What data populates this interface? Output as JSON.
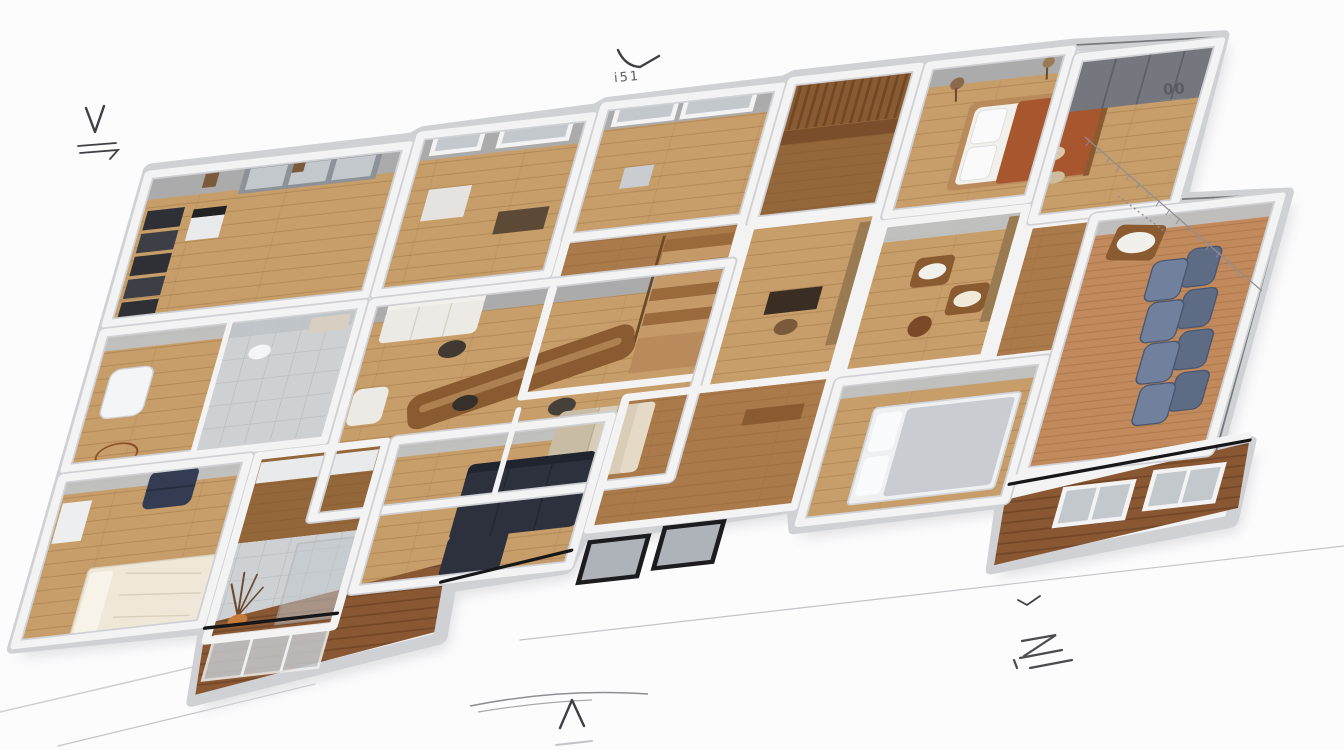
{
  "scene": {
    "kind": "3d-isometric-floor-plan-render",
    "style": "photoreal cutaway model of a single-storey house on white paper with faint pencil sketch marks",
    "background": "white"
  },
  "annotations": {
    "top_center_label": "i51",
    "top_right_label": "00"
  },
  "marks": {
    "top_center_check": "curved-check-stroke",
    "left_margin_mark": "v-with-bracket-arrow",
    "bottom_center_mark": "caret-arrow",
    "bottom_right_mark": "z-scribble-with-underlines",
    "bottom_right_tick": "small-check",
    "top_right_dimension": "hatched-diagonal-dimension-line",
    "ground_lines": "faint-pencil-ground-lines"
  },
  "palette": {
    "paper": "#fcfcfd",
    "wall-light": "#f3f3f4",
    "wall-edge": "#cfd1d5",
    "wall-face": "#a8acb2",
    "wall-face-light": "#bfc3c8",
    "wall-cut": "#17171a",
    "floor-light": "#c79e6a",
    "floor-rich": "#aa7a4a",
    "floor-dark": "#93673a",
    "floor-terra": "#c28a5c",
    "plank-line": "#7e5227",
    "tile": "#ced1d4",
    "tile-line": "#b8bbbf",
    "deck": "#8a5733",
    "deck-line": "#5f3c20",
    "shadow": "#dcdcdf",
    "sofa-navy": "#2c313d",
    "sofa-navy-dark": "#20242e",
    "denim": "#5d6b85",
    "denim-light": "#71809c",
    "beige": "#d9cdb8",
    "beige-dark": "#c9bca4",
    "white-soft": "#eceae4",
    "linen": "#f2f0ea",
    "rust": "#a8562e",
    "cream": "#efe8d8",
    "shelf-dark": "#2e3035",
    "shelf-dark2": "#3c3f45",
    "wood": "#8a5a30",
    "wood-light": "#b98a5c",
    "glass": "#c3c8cd",
    "glass-dark": "#aeb3ba",
    "frame-dark": "#1c1c1e",
    "orange": "#c77b3a",
    "ink": "#3f3f44",
    "ink-soft": "#8f8f94",
    "sketch": "#c4c4c8"
  },
  "rooms": [
    {
      "id": "storage-room-nw",
      "floor": "light-oak",
      "contents": [
        "dark-shelving-stack",
        "glass-display-cabinet",
        "device-table",
        "wall-frames"
      ]
    },
    {
      "id": "bedroom-nw",
      "floor": "light-oak",
      "contents": [
        "windows",
        "cabinet",
        "wood-bench"
      ]
    },
    {
      "id": "window-room-n",
      "floor": "light-oak",
      "contents": [
        "windows",
        "side-table"
      ]
    },
    {
      "id": "stair-hall",
      "floor": "rich-oak",
      "contents": [
        "staircase",
        "railing",
        "landing"
      ]
    },
    {
      "id": "wardrobe-corridor",
      "floor": "dark-walnut",
      "contents": [
        "wood-slat-wardrobe"
      ]
    },
    {
      "id": "bedroom-ne",
      "floor": "light-oak",
      "contents": [
        "double-bed-rust-blanket",
        "pillows",
        "coat-stand"
      ]
    },
    {
      "id": "closet-room-e",
      "floor": "light-oak",
      "contents": [
        "gray-wardrobe",
        "floor-cushions"
      ]
    },
    {
      "id": "bathroom-w",
      "floor": "light-oak-and-tile",
      "contents": [
        "bathtub",
        "toilet",
        "vanity",
        "sketch-round-table"
      ]
    },
    {
      "id": "living-room",
      "floor": "light-oak",
      "contents": [
        "white-sofa",
        "white-armchair",
        "wood-dining-table",
        "stools",
        "beige-sectional"
      ]
    },
    {
      "id": "study-e",
      "floor": "light-oak",
      "contents": [
        "dark-desk",
        "desk-chair",
        "wall-shelf"
      ]
    },
    {
      "id": "sitting-room-e",
      "floor": "light-oak",
      "contents": [
        "wood-armchairs-white-cushions",
        "leather-pouf",
        "wall-shelf"
      ]
    },
    {
      "id": "bedroom-sw",
      "floor": "light-oak",
      "contents": [
        "cream-bed",
        "navy-armchair",
        "white-desk"
      ]
    },
    {
      "id": "bathroom-s",
      "floor": "walnut-and-tile",
      "contents": [
        "counter",
        "shower-glass",
        "branch-decor-orange-pot",
        "sliding-glass-doors"
      ]
    },
    {
      "id": "lounge-s",
      "floor": "light-oak",
      "contents": [
        "navy-l-sofa"
      ]
    },
    {
      "id": "hall-s",
      "floor": "rich-oak",
      "contents": [
        "console-table"
      ]
    },
    {
      "id": "bedroom-se",
      "floor": "light-oak",
      "contents": [
        "bed-gray-blanket",
        "black-framed-windows"
      ]
    },
    {
      "id": "lounge-e",
      "floor": "terracotta",
      "contents": [
        "denim-sectional-sofa",
        "wood-lounge-chair-white-cushion"
      ]
    },
    {
      "id": "deck-sw",
      "floor": "deck-boards",
      "contents": [
        "steps"
      ]
    },
    {
      "id": "siding-se",
      "floor": "wood-siding",
      "contents": [
        "white-framed-windows",
        "white-cap-rail"
      ]
    }
  ]
}
